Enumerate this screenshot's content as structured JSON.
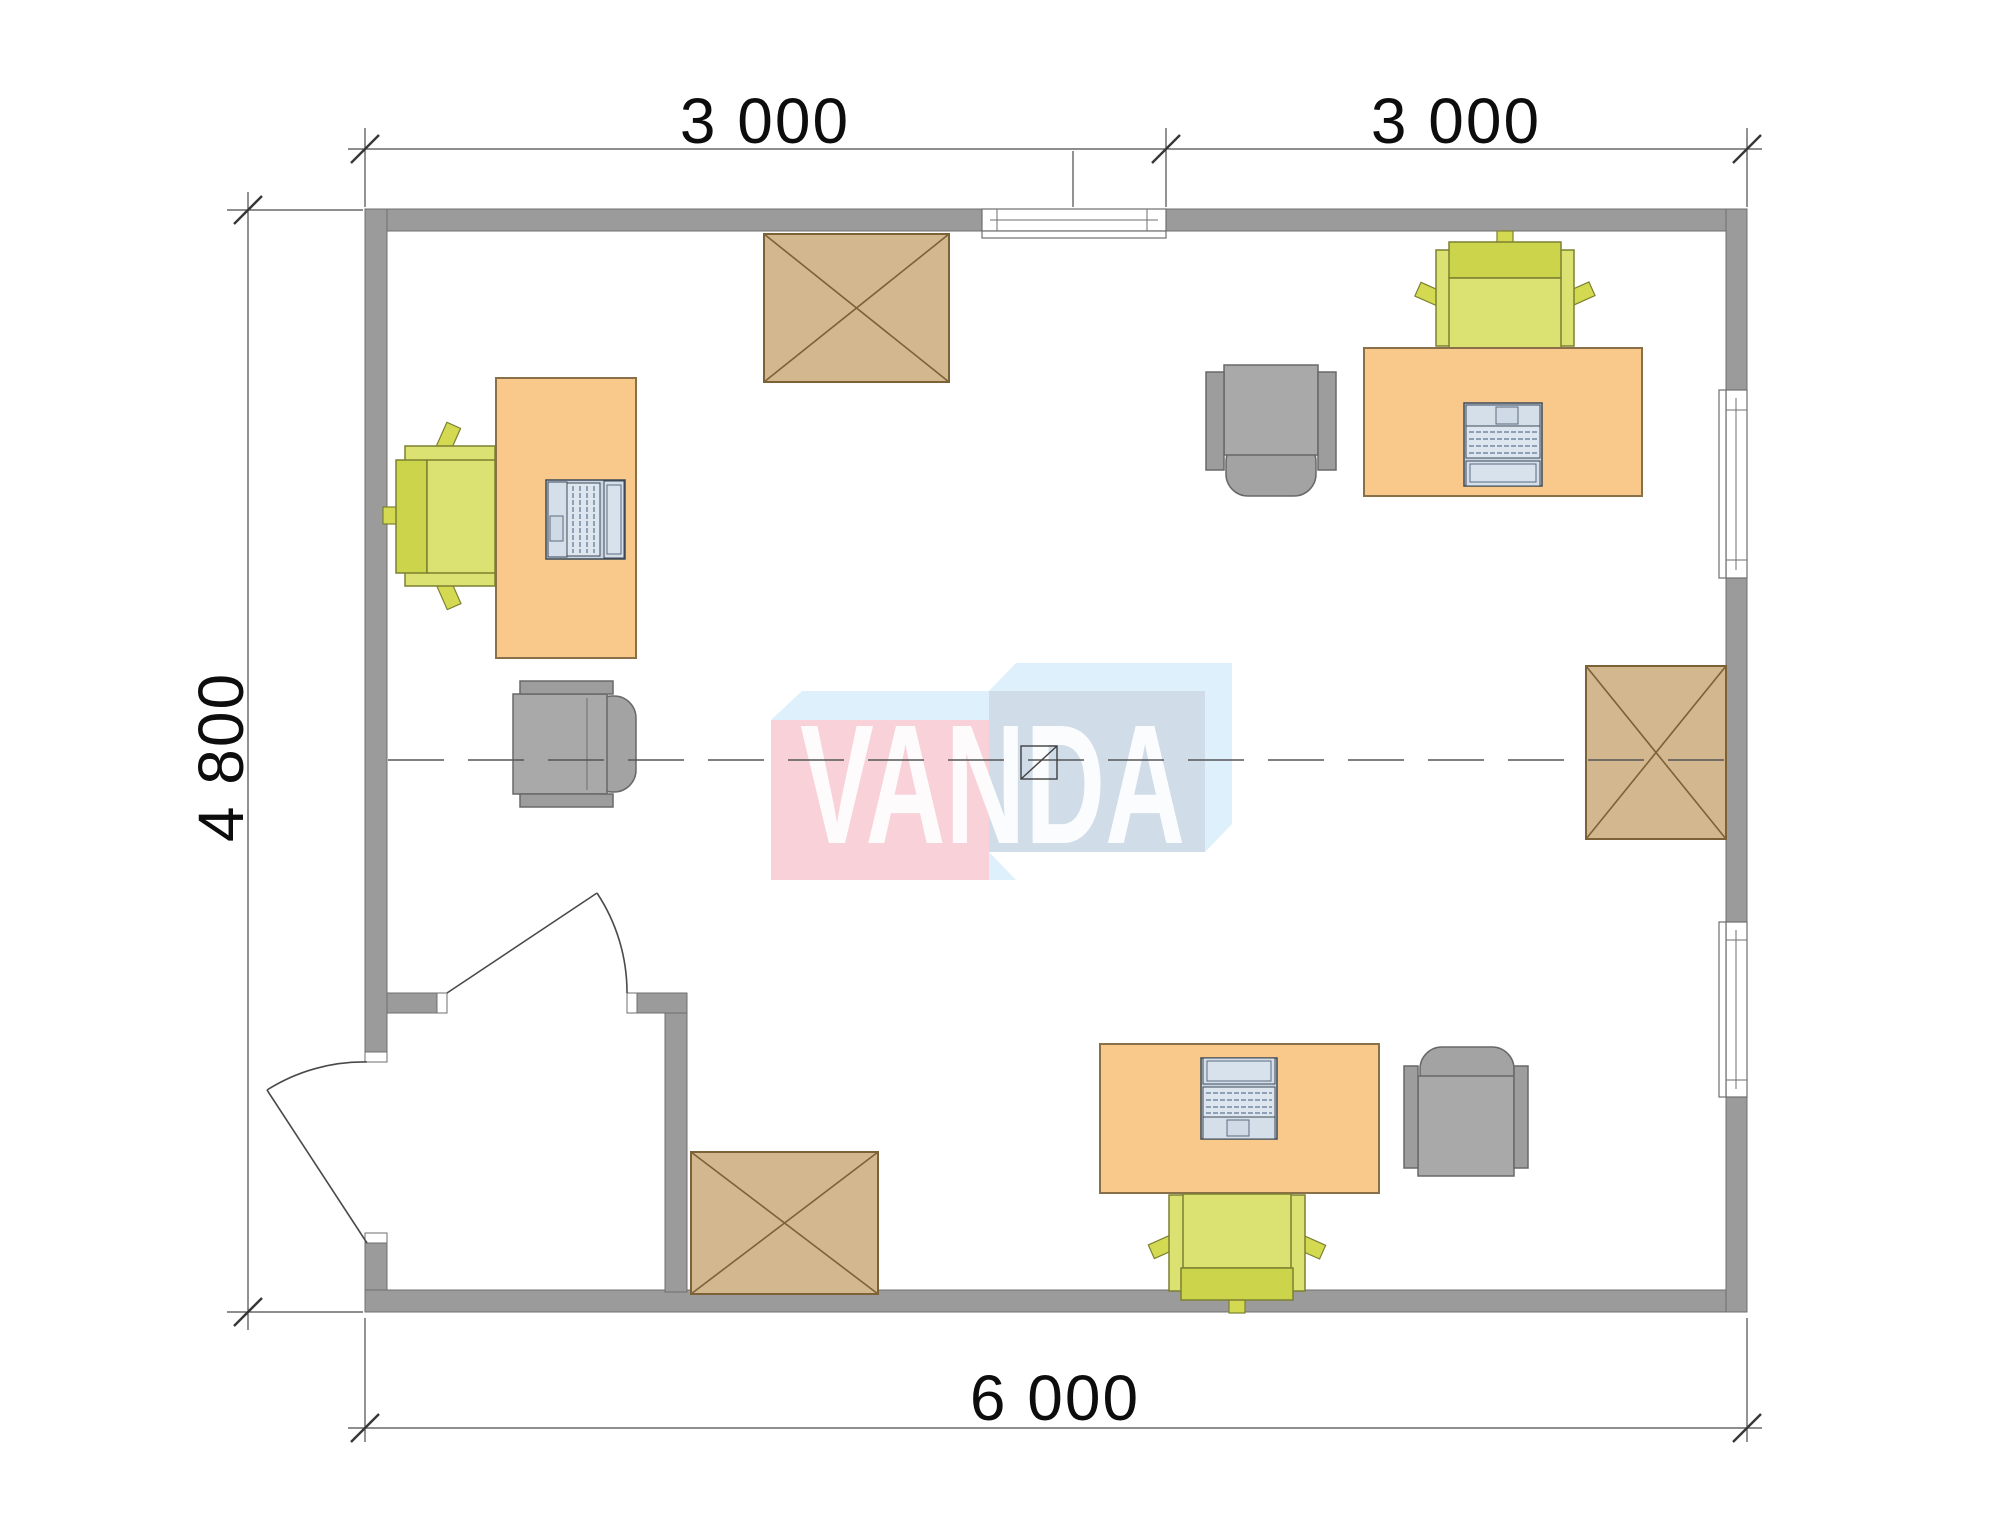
{
  "dimensions": {
    "top_left": "3 000",
    "top_right": "3 000",
    "left": "4 800",
    "bottom": "6 000"
  },
  "watermark": {
    "text": "VANDA",
    "colors": {
      "front_left": "#f8cdd5",
      "front_right": "#cbd9e7",
      "top_faces": "#d9eefb",
      "letters": "#ffffff"
    }
  },
  "palette": {
    "background": "#ffffff",
    "wall": "#9b9b9b",
    "wall_outline": "#6f6f6f",
    "desk": "#f9c88b",
    "desk_outline": "#8a7048",
    "chair_seat": "#dbe272",
    "chair_back": "#ccd44c",
    "chair_outline": "#7d8030",
    "armchair": "#a9a9a9",
    "armchair_outline": "#686868",
    "crate": "#d2b78f",
    "crate_outline": "#7d6238",
    "laptop": "#c9d5e3",
    "annotation_line": "#4a4a4a",
    "dimension_text": "#0d0d0d"
  },
  "plan_contents": {
    "desks": 3,
    "task_chairs": 3,
    "armchairs": 3,
    "laptops": 3,
    "crossed_crates": 3,
    "doors": 2,
    "windows": 3,
    "entrance_vestibule": 1
  }
}
